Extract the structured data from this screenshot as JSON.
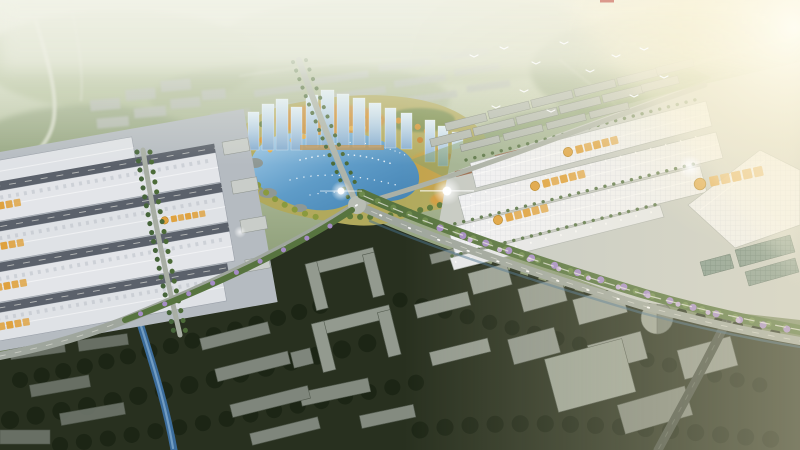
{
  "image": {
    "type": "aerial-architectural-rendering",
    "alt": "Bird's-eye architectural rendering of a planned logistics and industrial park: rows of white warehouse roofs with gold signage on the left and right, a central lake park with autumn-colored trees and blue glass towers, hazy green countryside at the horizon, and a dark existing city district with gray massing buildings in the foreground, crossed by tree-lined roads, a canal and a purple-planted greenway, lit by warm sunlight from the upper right."
  },
  "palette": {
    "haze_sky": "#e6e9da",
    "far_fields": "#9fae89",
    "lake_shallow": "#a5cde9",
    "lake_deep": "#3f7fb0",
    "park_ground": "#b1a95c",
    "autumn_orange": "#d4912f",
    "glass_tower": "#a9cbe2",
    "roof_left": "#dfe2e6",
    "roof_right": "#f0f1f4",
    "roof_gap": "#5b616b",
    "apron": "#bfc4c2",
    "signage_gold": "#dfa23f",
    "road": "#9fa69d",
    "greenway_green": "#57743f",
    "greenway_purple": "#a58cc6",
    "canal": "#3c6d9c",
    "dark_city": "#28301f",
    "dark_trees": "#1b2415",
    "massing_gray": "#939a8f",
    "sun_glow": "#fdf8e6"
  },
  "scene": {
    "signage": {
      "color": "#dfa23f",
      "logo_color": "#b5811f",
      "style": "circular gold logo followed by short run of gold Chinese characters",
      "legible": false,
      "count": 9
    },
    "regions": [
      {
        "name": "horizon-haze",
        "description": "washed-out hazy countryside with winding light roads"
      },
      {
        "name": "distant-residential",
        "description": "rows of small gray slab buildings fading into haze"
      },
      {
        "name": "central-lake-park",
        "description": "kidney-shaped sparkling lake ringed by autumn orange and green trees"
      },
      {
        "name": "glass-tower-group",
        "description": "clusters of light-blue glass high-rises north and east of the lake"
      },
      {
        "name": "left-warehouse-cluster",
        "description": "four long white warehouse rows with gold rooftop signage"
      },
      {
        "name": "right-warehouse-cluster",
        "description": "large bright gridded warehouse roofs with gold rooftop signage"
      },
      {
        "name": "greenway",
        "description": "wavy landscaped strip with purple and green trees and a white path"
      },
      {
        "name": "foreground-city",
        "description": "dark existing district of gray untextured massing buildings in trees"
      },
      {
        "name": "canal",
        "description": "blue water channel running to the bottom edge"
      },
      {
        "name": "sun-light",
        "description": "warm glow and lens flares from the upper right"
      }
    ]
  }
}
